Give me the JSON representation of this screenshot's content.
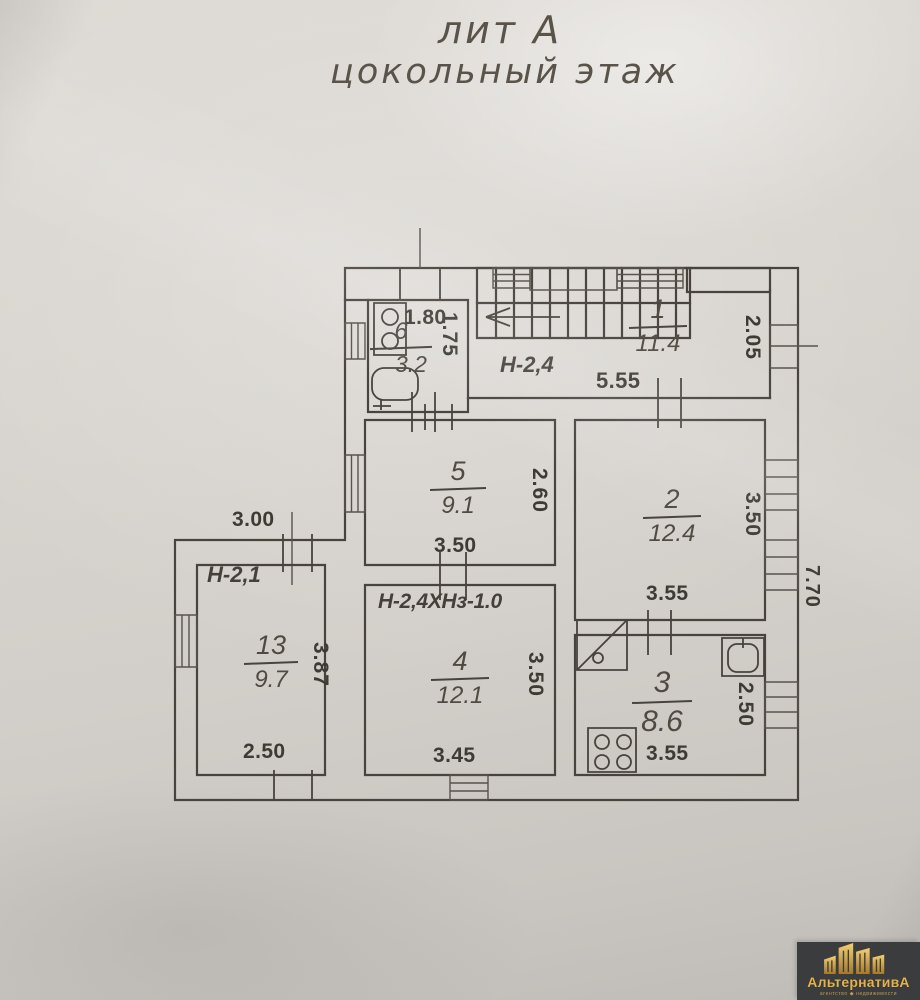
{
  "title": {
    "line1": "лит А",
    "line2": "цокольный этаж"
  },
  "rooms": {
    "r1": {
      "number": "1",
      "area": "11.4"
    },
    "r2": {
      "number": "2",
      "area": "12.4"
    },
    "r3": {
      "number": "3",
      "area": "8.6"
    },
    "r4": {
      "number": "4",
      "area": "12.1"
    },
    "r5": {
      "number": "5",
      "area": "9.1"
    },
    "r6": {
      "number": "6",
      "area": "3.2"
    },
    "r13": {
      "number": "13",
      "area": "9.7"
    }
  },
  "heights": {
    "hall": "Н-2,4",
    "room13": "Н-2,1",
    "room4": "Н-2,4ХНз-1.0"
  },
  "dims": {
    "room6_width": "1.80",
    "room6_depth": "1.75",
    "hall_width": "5.55",
    "room1_window": "2.05",
    "room5_width": "3.50",
    "room5_depth": "2.60",
    "room2_width": "3.55",
    "room2_depth": "3.50",
    "room4_width": "3.45",
    "room4_depth": "3.50",
    "room3_width": "3.55",
    "room3_depth": "2.50",
    "room13_width": "2.50",
    "room13_depth": "3.87",
    "annex_width": "3.00",
    "right_side_total": "7.70"
  },
  "logo": {
    "name": "АльтернативА",
    "tagline": "агентство ◆ недвижимости"
  },
  "colors": {
    "ink": "#48433d",
    "paper": "#d7d3ce",
    "logo_bg": "#3a3c3e",
    "logo_gold": "#e3b24b"
  }
}
